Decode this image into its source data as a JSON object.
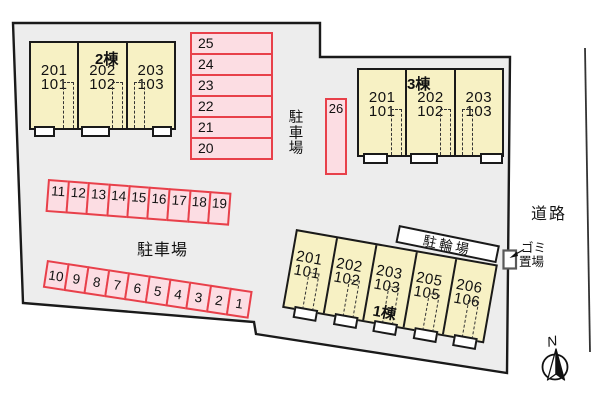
{
  "labels": {
    "parking_side": "駐車場",
    "parking_main": "駐車場",
    "road": "道路",
    "garbage_line1": "ゴミ",
    "garbage_line2": "置場",
    "bicycle_shed": "駐輪場",
    "north": "N"
  },
  "buildings": [
    {
      "name": "2棟",
      "units": [
        {
          "upper": "201",
          "lower": "101"
        },
        {
          "upper": "202",
          "lower": "102"
        },
        {
          "upper": "203",
          "lower": "103"
        }
      ]
    },
    {
      "name": "3棟",
      "units": [
        {
          "upper": "201",
          "lower": "101"
        },
        {
          "upper": "202",
          "lower": "102"
        },
        {
          "upper": "203",
          "lower": "103"
        }
      ]
    },
    {
      "name": "1棟",
      "units": [
        {
          "upper": "201",
          "lower": "101"
        },
        {
          "upper": "202",
          "lower": "102"
        },
        {
          "upper": "203",
          "lower": "103"
        },
        {
          "upper": "205",
          "lower": "105"
        },
        {
          "upper": "206",
          "lower": "106"
        }
      ]
    }
  ],
  "parking": {
    "column_stalls": [
      "25",
      "24",
      "23",
      "22",
      "21",
      "20"
    ],
    "stall_26": "26",
    "upper_row_stalls": [
      "11",
      "12",
      "13",
      "14",
      "15",
      "16",
      "17",
      "18",
      "19"
    ],
    "lower_row_stalls": [
      "10",
      "9",
      "8",
      "7",
      "6",
      "5",
      "4",
      "3",
      "2",
      "1"
    ]
  },
  "colors": {
    "site_fill": "#ededed",
    "outline": "#1a1a1a",
    "building_fill": "#f7f1c4",
    "stall_fill": "#fcdde3",
    "stall_border": "#e8404a"
  }
}
